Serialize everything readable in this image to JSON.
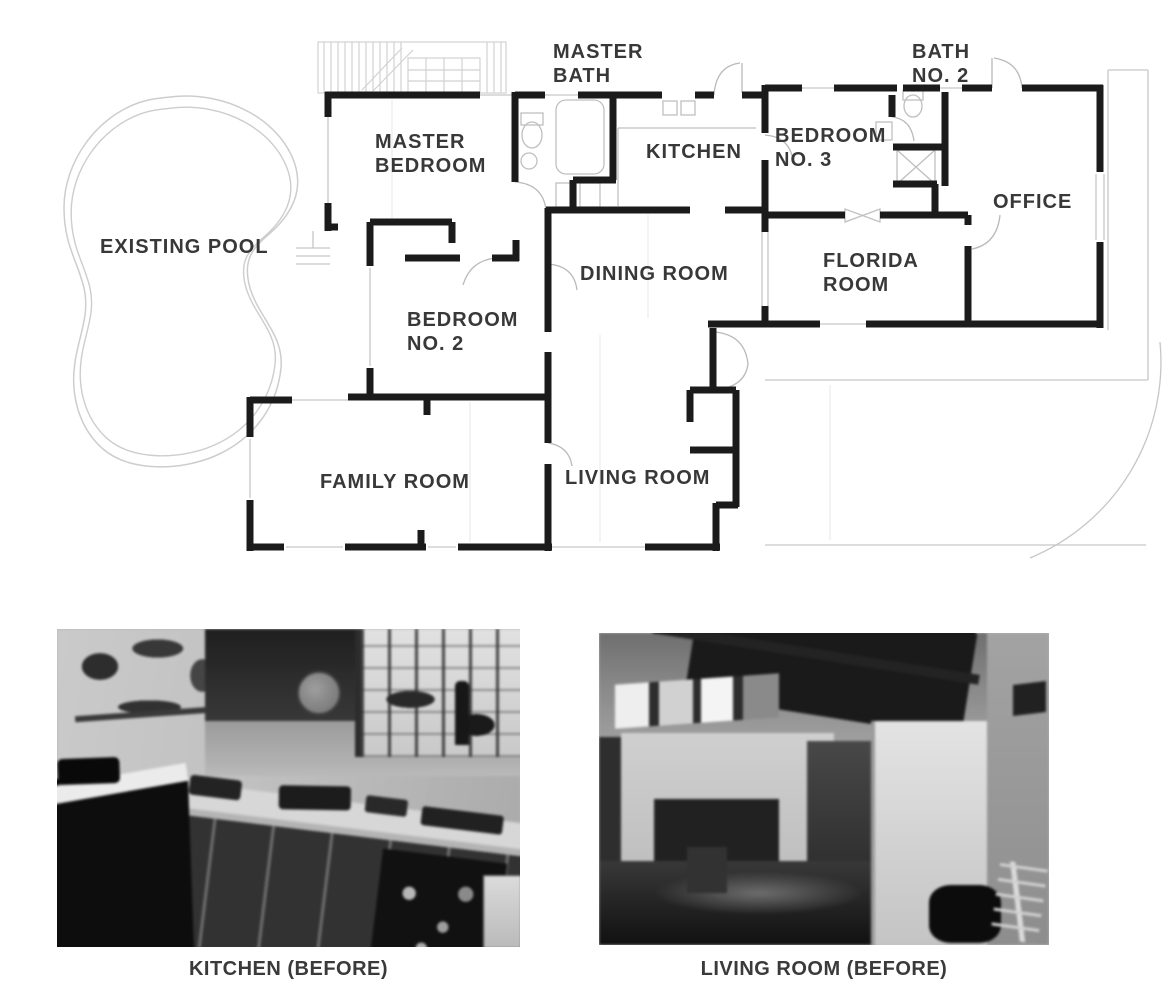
{
  "plan": {
    "pool_label": "EXISTING POOL",
    "rooms": {
      "master_bedroom": {
        "l1": "MASTER",
        "l2": "BEDROOM"
      },
      "master_bath": {
        "l1": "MASTER",
        "l2": "BATH"
      },
      "kitchen": {
        "l1": "KITCHEN"
      },
      "bedroom_3": {
        "l1": "BEDROOM",
        "l2": "NO. 3"
      },
      "bath_2": {
        "l1": "BATH",
        "l2": "NO. 2"
      },
      "office": {
        "l1": "OFFICE"
      },
      "dining_room": {
        "l1": "DINING ROOM"
      },
      "florida_room": {
        "l1": "FLORIDA",
        "l2": "ROOM"
      },
      "bedroom_2": {
        "l1": "BEDROOM",
        "l2": "NO. 2"
      },
      "family_room": {
        "l1": "FAMILY ROOM"
      },
      "living_room": {
        "l1": "LIVING ROOM"
      }
    }
  },
  "photos": {
    "kitchen": {
      "caption": "KITCHEN (BEFORE)"
    },
    "living_room": {
      "caption": "LIVING ROOM (BEFORE)"
    }
  },
  "colors": {
    "wall": "#1b1b1b",
    "thin_line": "#c6c6c6",
    "pool_line": "#cdcdcd",
    "door_arc": "#b9b9b9",
    "label_text": "#383838",
    "background": "#ffffff"
  }
}
